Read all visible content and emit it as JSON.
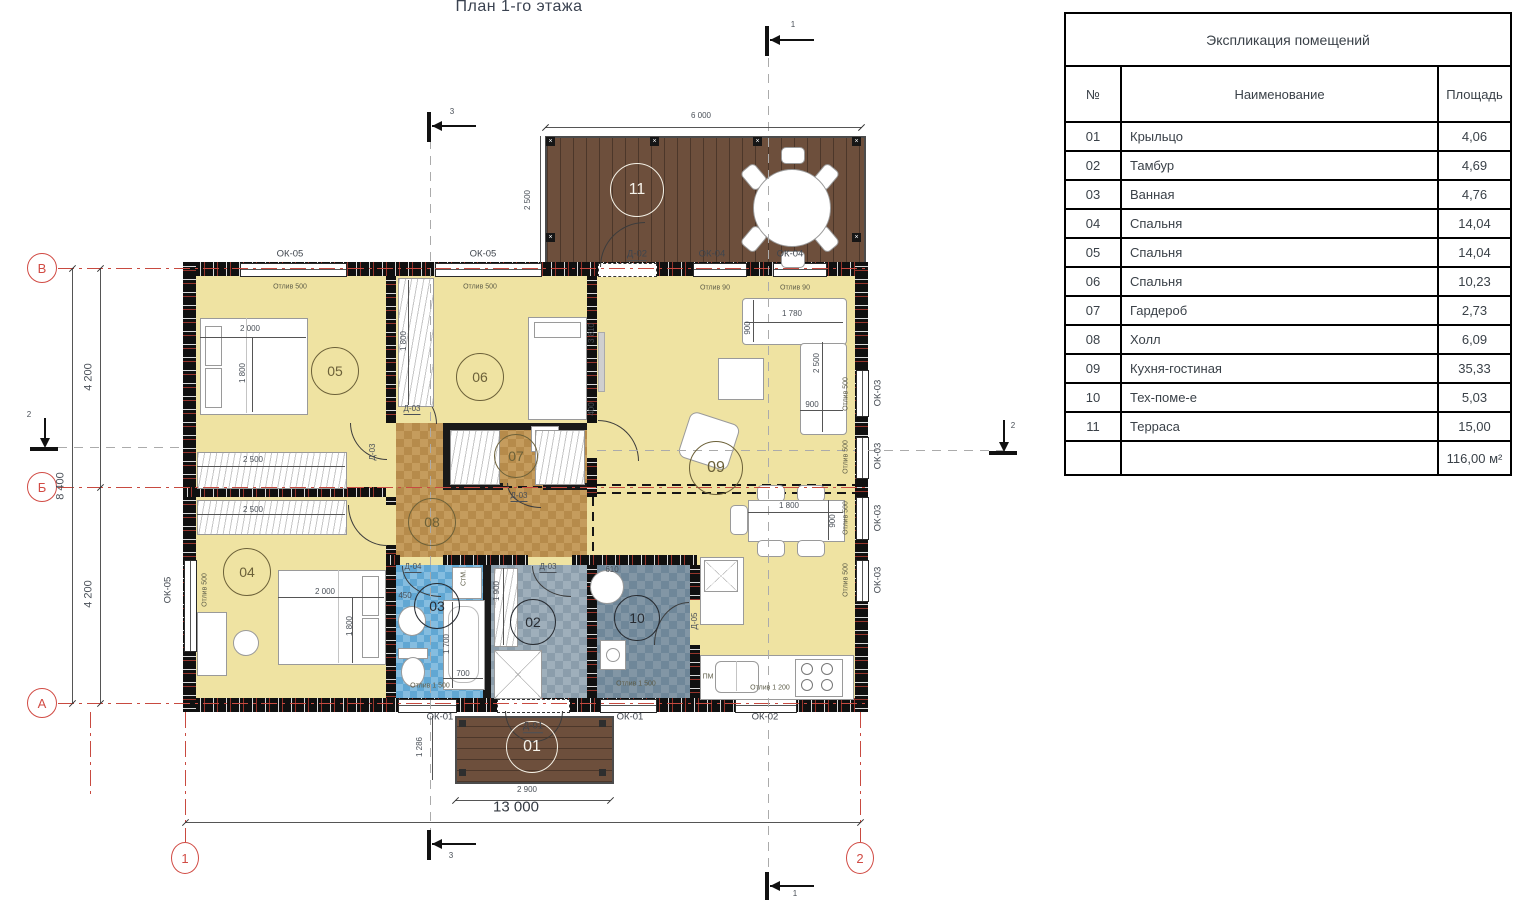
{
  "title": "План 1-го этажа",
  "table": {
    "title": "Экспликация помещений",
    "headers": {
      "num": "№",
      "name": "Наименование",
      "area": "Площадь"
    },
    "rows": [
      {
        "num": "01",
        "name": "Крыльцо",
        "area": "4,06"
      },
      {
        "num": "02",
        "name": "Тамбур",
        "area": "4,69"
      },
      {
        "num": "03",
        "name": "Ванная",
        "area": "4,76"
      },
      {
        "num": "04",
        "name": "Спальня",
        "area": "14,04"
      },
      {
        "num": "05",
        "name": "Спальня",
        "area": "14,04"
      },
      {
        "num": "06",
        "name": "Спальня",
        "area": "10,23"
      },
      {
        "num": "07",
        "name": "Гардероб",
        "area": "2,73"
      },
      {
        "num": "08",
        "name": "Холл",
        "area": "6,09"
      },
      {
        "num": "09",
        "name": "Кухня-гостиная",
        "area": "35,33"
      },
      {
        "num": "10",
        "name": "Тех-поме-е",
        "area": "5,03"
      },
      {
        "num": "11",
        "name": "Терраса",
        "area": "15,00"
      }
    ],
    "total": "116,00 м²"
  },
  "rooms": {
    "r01": "01",
    "r02": "02",
    "r03": "03",
    "r04": "04",
    "r05": "05",
    "r06": "06",
    "r07": "07",
    "r08": "08",
    "r09": "09",
    "r10": "10",
    "r11": "11"
  },
  "axes": {
    "a": "А",
    "b": "Б",
    "v": "В",
    "n1": "1",
    "n2": "2"
  },
  "sections": {
    "s1": "1",
    "s2": "2",
    "s3": "3"
  },
  "windows": {
    "ok01": "ОК-01",
    "ok02": "ОК-02",
    "ok03": "ОК-03",
    "ok04": "ОК-04",
    "ok05": "ОК-05"
  },
  "doors": {
    "d01": "Д-01",
    "d02": "Д-02",
    "d03": "Д-03",
    "d04": "Д-04",
    "d05": "Д-05"
  },
  "dims": {
    "d13000": "13 000",
    "d8400": "8 400",
    "d4200": "4 200",
    "d6000": "6 000",
    "d2500": "2 500",
    "d2900": "2 900",
    "d1286": "1 286",
    "d2000": "2 000",
    "d1800": "1 800",
    "d1780": "1 780",
    "d900": "900",
    "d1900": "1 900",
    "d1700": "1 700",
    "d700": "700",
    "d610": "610",
    "d450": "450",
    "d3810": "3 810",
    "d400": "400"
  },
  "annotations": {
    "otliv500": "Отлив 500",
    "otliv90": "Отлив 90",
    "otliv1500": "Отлив 1 500",
    "otliv1200": "Отлив 1 200",
    "stm": "СтМ.",
    "pm": "ПМ"
  }
}
